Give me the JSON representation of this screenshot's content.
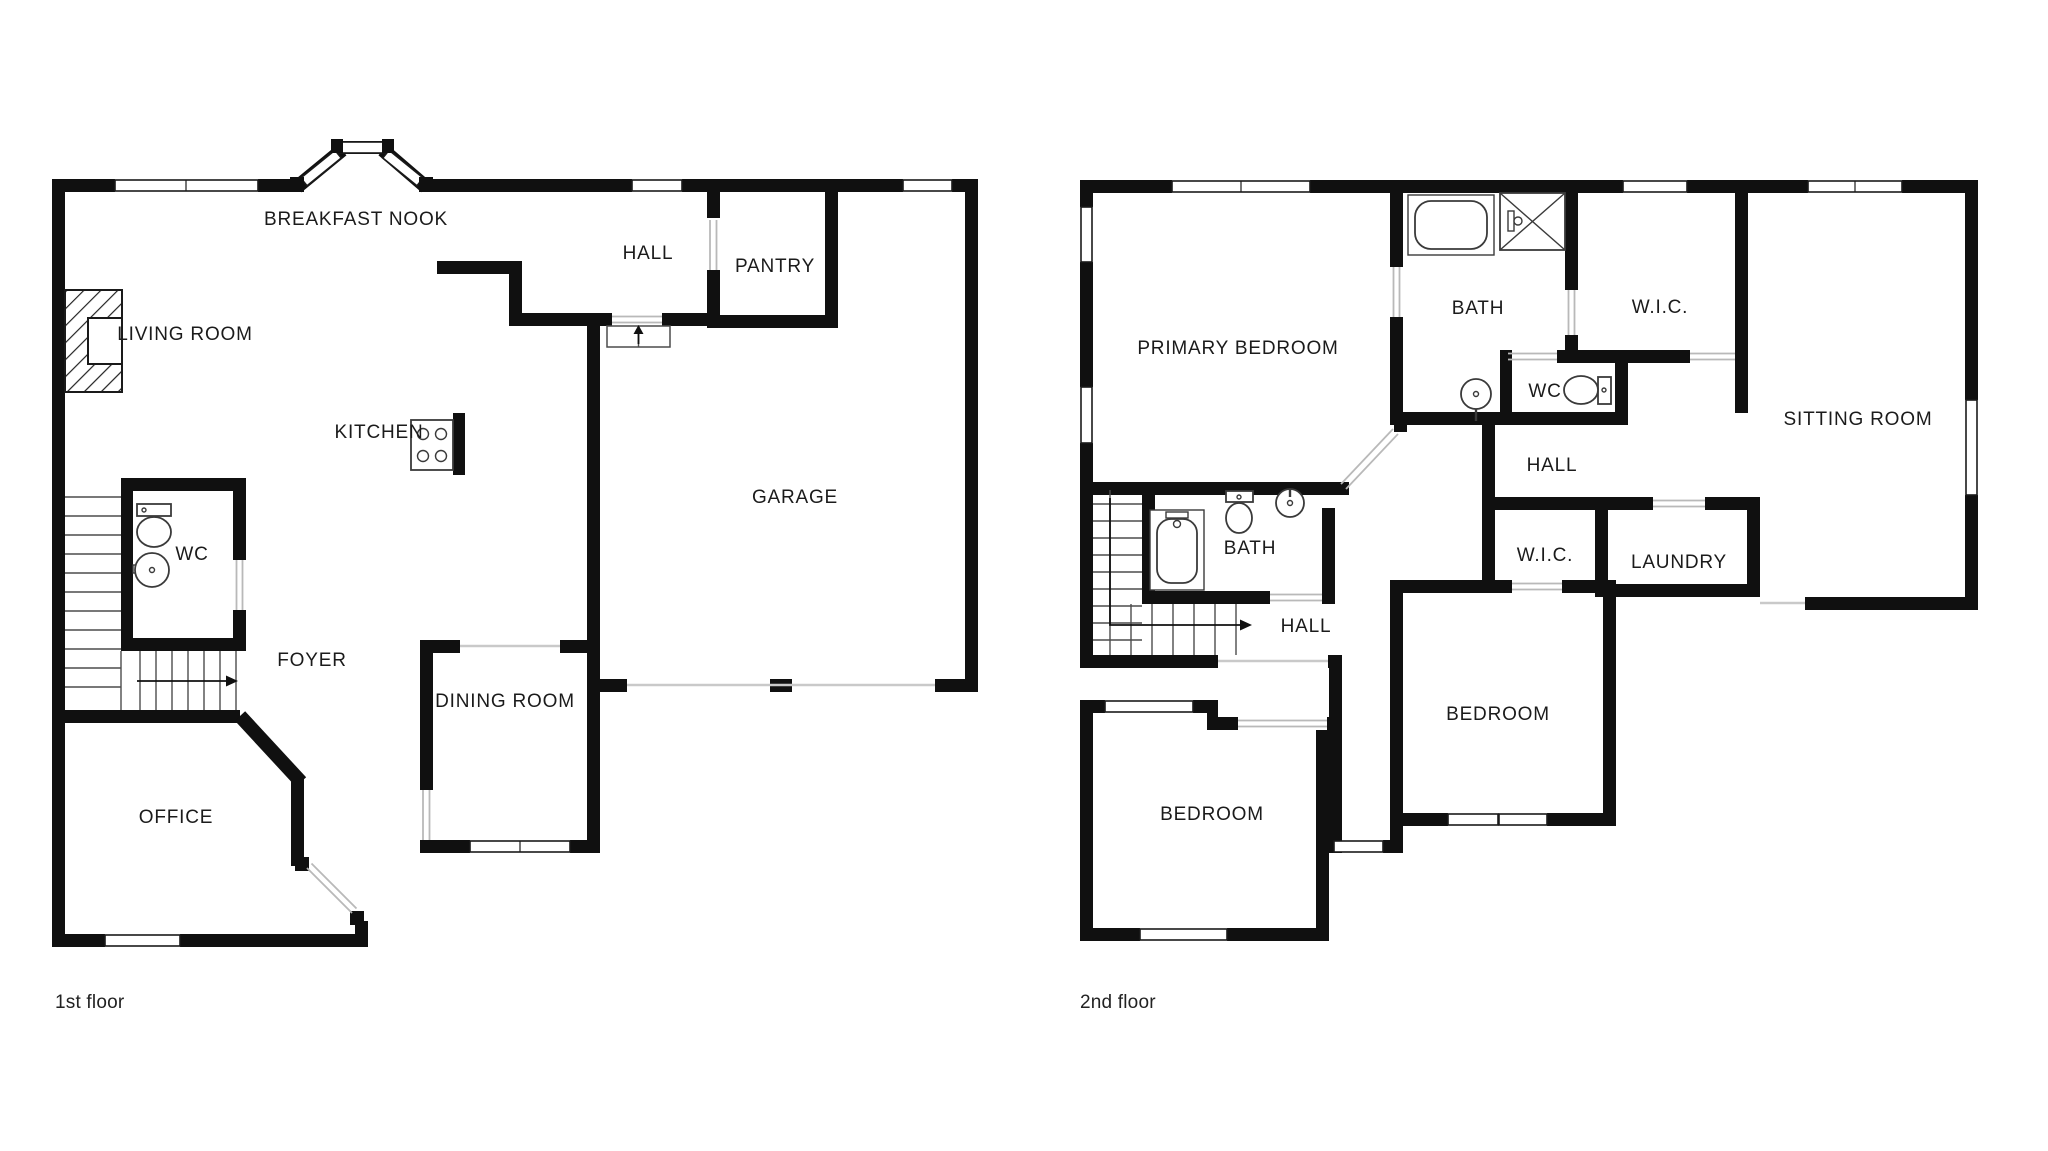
{
  "document": {
    "type": "floor-plan",
    "background_color": "#ffffff",
    "wall_color": "#101010"
  },
  "floor1": {
    "caption": "1st floor",
    "rooms": {
      "breakfast_nook": "BREAKFAST NOOK",
      "hall": "HALL",
      "pantry": "PANTRY",
      "living_room": "LIVING ROOM",
      "kitchen": "KITCHEN",
      "garage": "GARAGE",
      "wc": "WC",
      "foyer": "FOYER",
      "dining_room": "DINING ROOM",
      "office": "OFFICE"
    },
    "fixtures": [
      "fireplace",
      "stove",
      "toilet",
      "sink",
      "stairs-up",
      "bay-window",
      "garage-door"
    ]
  },
  "floor2": {
    "caption": "2nd floor",
    "rooms": {
      "primary_bedroom": "PRIMARY BEDROOM",
      "bath_primary": "BATH",
      "wic_primary": "W.I.C.",
      "sitting_room": "SITTING ROOM",
      "wc": "WC",
      "hall_upper": "HALL",
      "bath": "BATH",
      "hall": "HALL",
      "wic_mid": "W.I.C.",
      "laundry": "LAUNDRY",
      "bedroom_left": "BEDROOM",
      "bedroom_right": "BEDROOM"
    },
    "fixtures": [
      "bathtub",
      "shower",
      "pedestal-sink",
      "toilet",
      "bathtub-2",
      "toilet-2",
      "sink-2",
      "stairs"
    ]
  }
}
